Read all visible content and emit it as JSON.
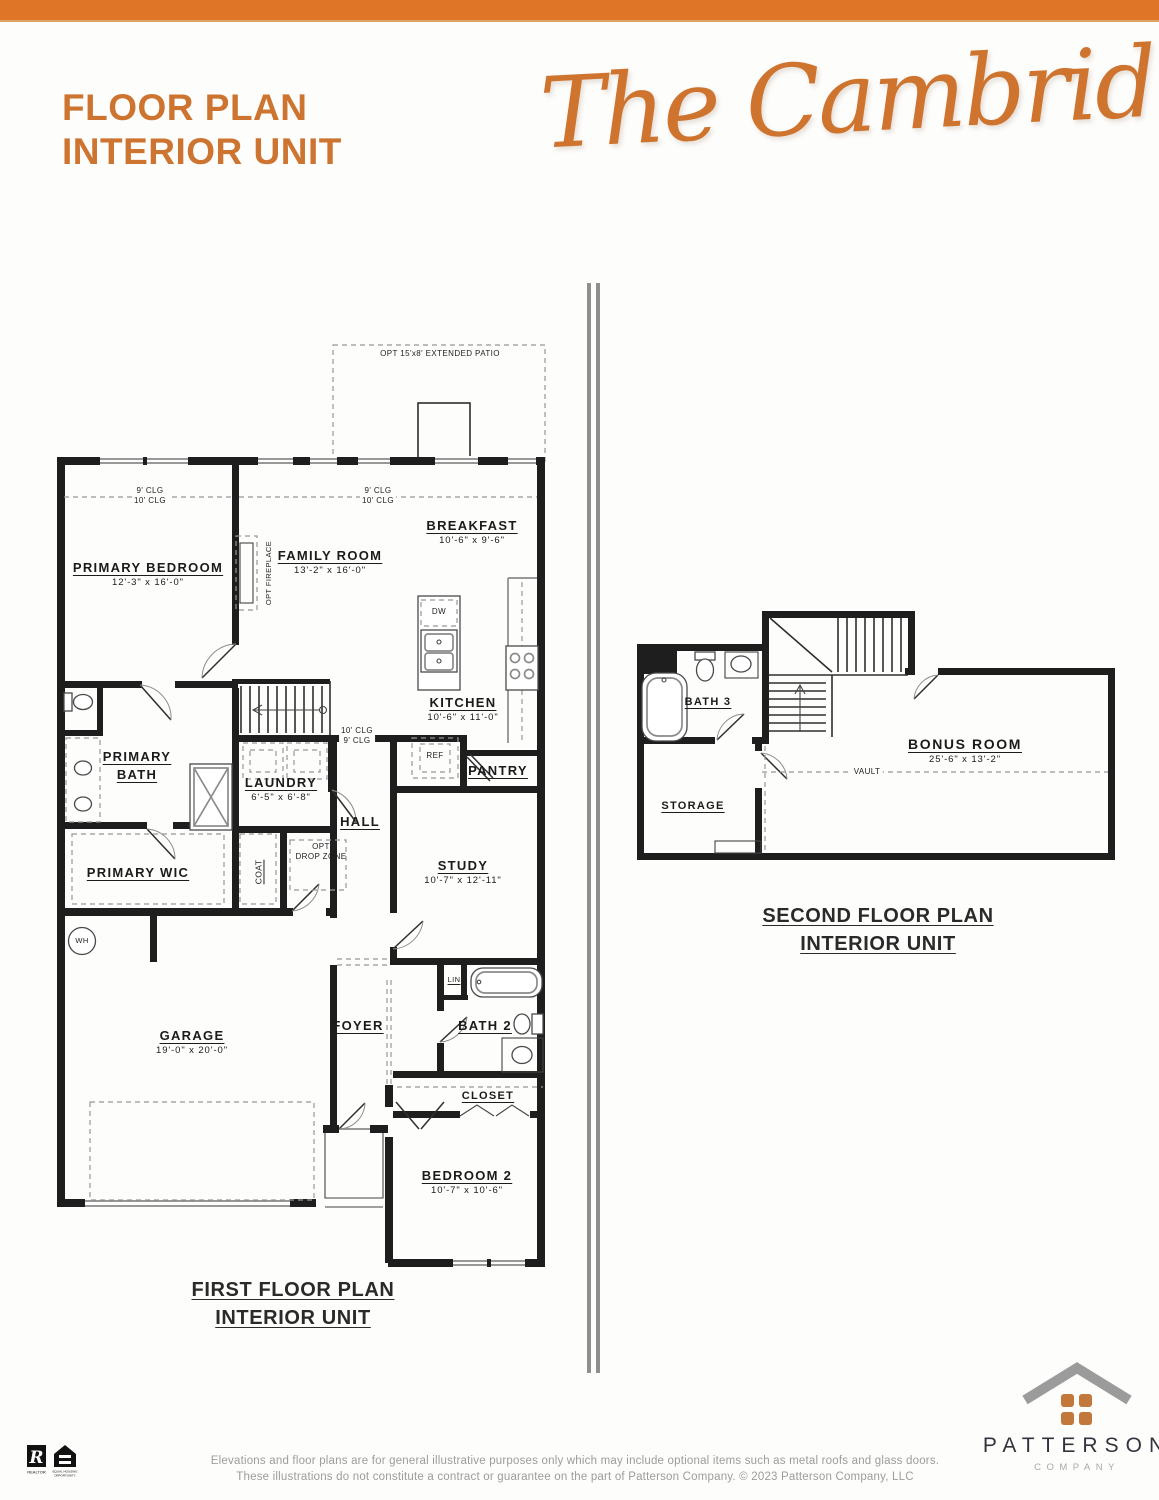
{
  "header": {
    "title_line1": "FLOOR PLAN",
    "title_line2": "INTERIOR UNIT",
    "plan_name": "The Cambridge",
    "accent_color": "#cd7430",
    "bar_color": "#de7527"
  },
  "first_floor": {
    "caption_line1": "FIRST FLOOR PLAN",
    "caption_line2": "INTERIOR UNIT",
    "patio_note": "OPT 15'x8' EXTENDED PATIO",
    "ceiling_left_1": "9' CLG",
    "ceiling_left_2": "10' CLG",
    "ceiling_mid_1": "9' CLG",
    "ceiling_mid_2": "10' CLG",
    "ceiling_hall_1": "10' CLG",
    "ceiling_hall_2": "9' CLG",
    "rooms": [
      {
        "name": "PRIMARY BEDROOM",
        "dims": "12'-3\" x 16'-0\""
      },
      {
        "name": "FAMILY ROOM",
        "dims": "13'-2\" x 16'-0\""
      },
      {
        "name": "BREAKFAST",
        "dims": "10'-6\" x 9'-6\""
      },
      {
        "name": "KITCHEN",
        "dims": "10'-6\" x 11'-0\""
      },
      {
        "name": "PRIMARY BATH",
        "dims": ""
      },
      {
        "name": "LAUNDRY",
        "dims": "6'-5\" x 6'-8\""
      },
      {
        "name": "HALL",
        "dims": ""
      },
      {
        "name": "PANTRY",
        "dims": ""
      },
      {
        "name": "STUDY",
        "dims": "10'-7\" x 12'-11\""
      },
      {
        "name": "PRIMARY WIC",
        "dims": ""
      },
      {
        "name": "GARAGE",
        "dims": "19'-0\" x 20'-0\""
      },
      {
        "name": "FOYER",
        "dims": ""
      },
      {
        "name": "BATH 2",
        "dims": ""
      },
      {
        "name": "CLOSET",
        "dims": ""
      },
      {
        "name": "BEDROOM 2",
        "dims": "10'-7\" x 10'-6\""
      }
    ],
    "fixtures": {
      "dw": "DW",
      "ref": "REF",
      "wh": "WH",
      "lin": "LIN",
      "coat": "COAT",
      "drop_zone_line1": "OPT",
      "drop_zone_line2": "DROP ZONE",
      "fireplace": "OPT FIREPLACE"
    }
  },
  "second_floor": {
    "caption_line1": "SECOND FLOOR PLAN",
    "caption_line2": "INTERIOR UNIT",
    "vault_label": "VAULT",
    "rooms": [
      {
        "name": "BATH 3",
        "dims": ""
      },
      {
        "name": "STORAGE",
        "dims": ""
      },
      {
        "name": "BONUS ROOM",
        "dims": "25'-6\" x 13'-2\""
      }
    ]
  },
  "footer": {
    "disclaimer_line1": "Elevations and floor plans are for general illustrative purposes only which may include optional items such as metal roofs and glass doors.",
    "disclaimer_line2": "These illustrations do not constitute a contract or guarantee on the part of Patterson Company. © 2023 Patterson Company, LLC",
    "brand_name": "PATTERSON",
    "brand_sub": "COMPANY",
    "realtor_r": "R",
    "realtor_label": "REALTOR",
    "eho_line1": "EQUAL HOUSING",
    "eho_line2": "OPPORTUNITY"
  }
}
